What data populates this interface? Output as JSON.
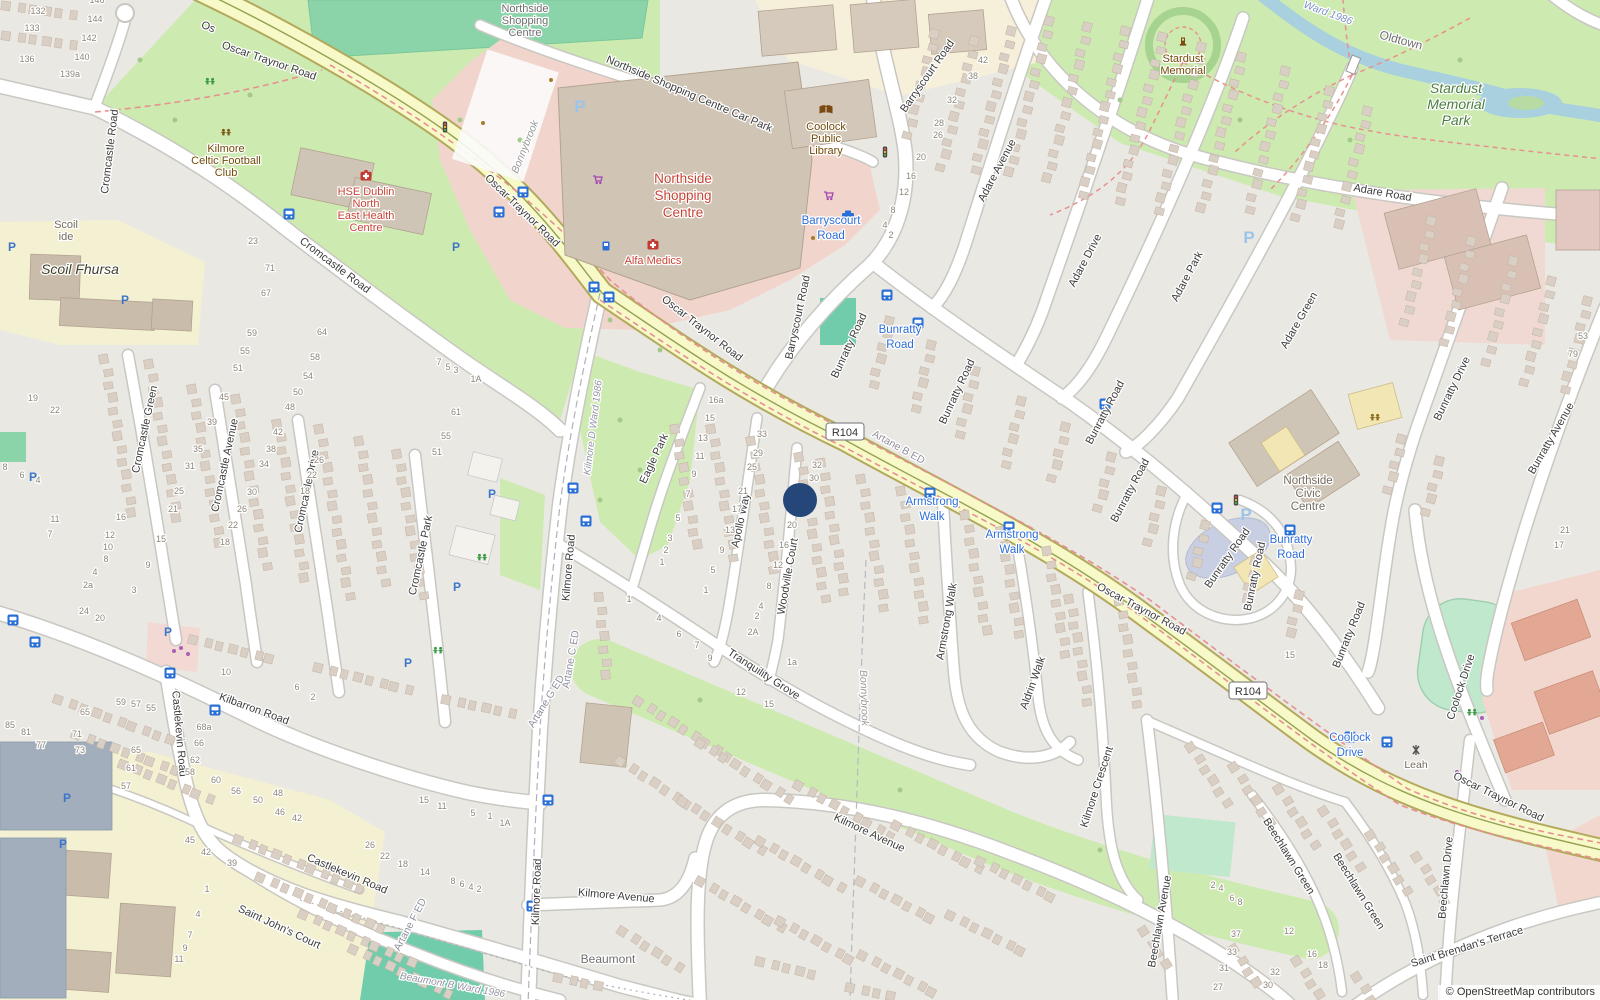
{
  "attribution": "© OpenStreetMap contributors",
  "marker": {
    "x": 800,
    "y": 500
  },
  "shields": [
    {
      "t": "R104",
      "x": 845,
      "y": 432
    },
    {
      "t": "R104",
      "x": 1248,
      "y": 691
    }
  ],
  "street_labels": [
    {
      "t": "Os",
      "x": 207,
      "y": 30,
      "r": 22
    },
    {
      "t": "Oscar Traynor Road",
      "x": 268,
      "y": 64,
      "r": 19
    },
    {
      "t": "Oscar Traynor Road",
      "x": 520,
      "y": 213,
      "r": 44
    },
    {
      "t": "Oscar Traynor Road",
      "x": 700,
      "y": 331,
      "r": 38
    },
    {
      "t": "Oscar Traynor Road",
      "x": 1140,
      "y": 612,
      "r": 28
    },
    {
      "t": "Oscar Traynor Road",
      "x": 1497,
      "y": 800,
      "r": 26
    },
    {
      "t": "Northside Shopping Centre Car Park",
      "x": 688,
      "y": 97,
      "r": 23
    },
    {
      "t": "Cromcastle Road",
      "x": 113,
      "y": 152,
      "r": -83
    },
    {
      "t": "Cromcastle Road",
      "x": 333,
      "y": 268,
      "r": 37
    },
    {
      "t": "Cromcastle Green",
      "x": 148,
      "y": 430,
      "r": -78
    },
    {
      "t": "Cromcastle Avenue",
      "x": 228,
      "y": 466,
      "r": -78
    },
    {
      "t": "Cromcastle Drive",
      "x": 310,
      "y": 492,
      "r": -78
    },
    {
      "t": "Cromcastle Park",
      "x": 424,
      "y": 556,
      "r": -78
    },
    {
      "t": "Kilbarron Road",
      "x": 253,
      "y": 712,
      "r": 20
    },
    {
      "t": "Castlekevin Road",
      "x": 176,
      "y": 734,
      "r": 85
    },
    {
      "t": "Castlekevin Road",
      "x": 346,
      "y": 877,
      "r": 23
    },
    {
      "t": "Saint John's Court",
      "x": 278,
      "y": 930,
      "r": 25
    },
    {
      "t": "Kilmore Road",
      "x": 572,
      "y": 568,
      "r": -85
    },
    {
      "t": "Kilmore Road",
      "x": 540,
      "y": 892,
      "r": -88
    },
    {
      "t": "Kilmore Avenue",
      "x": 616,
      "y": 899,
      "r": 5
    },
    {
      "t": "Kilmore Avenue",
      "x": 868,
      "y": 836,
      "r": 25
    },
    {
      "t": "Eagle Park",
      "x": 657,
      "y": 460,
      "r": -65
    },
    {
      "t": "Apollo Way",
      "x": 744,
      "y": 521,
      "r": -78
    },
    {
      "t": "Woodville Court",
      "x": 791,
      "y": 577,
      "r": -80
    },
    {
      "t": "Tranquility Grove",
      "x": 762,
      "y": 677,
      "r": 33
    },
    {
      "t": "Armstrong Walk",
      "x": 950,
      "y": 622,
      "r": -80
    },
    {
      "t": "Aldrin Walk",
      "x": 1036,
      "y": 684,
      "r": -70
    },
    {
      "t": "Kilmore Crescent",
      "x": 1100,
      "y": 788,
      "r": -72
    },
    {
      "t": "Beechlawn Avenue",
      "x": 1163,
      "y": 922,
      "r": -80
    },
    {
      "t": "Beechlawn Green",
      "x": 1286,
      "y": 858,
      "r": 58
    },
    {
      "t": "Beechlawn Green",
      "x": 1356,
      "y": 893,
      "r": 58
    },
    {
      "t": "Beechlawn Drive",
      "x": 1449,
      "y": 878,
      "r": -85
    },
    {
      "t": "Saint Brendan's Terrace",
      "x": 1468,
      "y": 950,
      "r": -17
    },
    {
      "t": "Barryscourt Road",
      "x": 930,
      "y": 78,
      "r": -55
    },
    {
      "t": "Barryscourt Road",
      "x": 801,
      "y": 318,
      "r": -78
    },
    {
      "t": "Bunratty Road",
      "x": 852,
      "y": 347,
      "r": -65
    },
    {
      "t": "Bunratty Road",
      "x": 960,
      "y": 393,
      "r": -65
    },
    {
      "t": "Bunratty Road",
      "x": 1108,
      "y": 414,
      "r": -62
    },
    {
      "t": "Bunratty Road",
      "x": 1133,
      "y": 492,
      "r": -62
    },
    {
      "t": "Bunratty Road",
      "x": 1230,
      "y": 560,
      "r": -55
    },
    {
      "t": "Bunratty Road",
      "x": 1258,
      "y": 577,
      "r": -78
    },
    {
      "t": "Bunratty Road",
      "x": 1352,
      "y": 636,
      "r": -68
    },
    {
      "t": "Bunratty Drive",
      "x": 1455,
      "y": 390,
      "r": -64
    },
    {
      "t": "Bunratty Avenue",
      "x": 1554,
      "y": 440,
      "r": -60
    },
    {
      "t": "Adare Avenue",
      "x": 1000,
      "y": 172,
      "r": -62
    },
    {
      "t": "Adare Drive",
      "x": 1088,
      "y": 262,
      "r": -62
    },
    {
      "t": "Adare Park",
      "x": 1190,
      "y": 278,
      "r": -62
    },
    {
      "t": "Adare Green",
      "x": 1302,
      "y": 322,
      "r": -60
    },
    {
      "t": "Adare Road",
      "x": 1382,
      "y": 196,
      "r": 10
    },
    {
      "t": "Coolock Drive",
      "x": 1464,
      "y": 688,
      "r": -72
    }
  ],
  "transit_labels": [
    {
      "l1": "Barryscourt",
      "l2": "Road",
      "x": 831,
      "y": 224
    },
    {
      "l1": "Bunratty",
      "l2": "Road",
      "x": 900,
      "y": 333
    },
    {
      "l1": "Armstrong",
      "l2": "Walk",
      "x": 932,
      "y": 505
    },
    {
      "l1": "Armstrong",
      "l2": "Walk",
      "x": 1012,
      "y": 538
    },
    {
      "l1": "Bunratty",
      "l2": "Road",
      "x": 1291,
      "y": 543
    },
    {
      "l1": "Coolock",
      "l2": "Drive",
      "x": 1350,
      "y": 741
    }
  ],
  "poi_labels": [
    {
      "lines": [
        "Northside",
        "Shopping",
        "Centre"
      ],
      "x": 525,
      "y": 12,
      "cls": "grey",
      "lh": 12,
      "fs": 11
    },
    {
      "lines": [
        "Coolock",
        "Public",
        "Library"
      ],
      "x": 826,
      "y": 130,
      "cls": "brown",
      "icon": "library",
      "ix": 826,
      "iy": 110,
      "lh": 12,
      "fs": 11
    },
    {
      "lines": [
        "Northside",
        "Shopping",
        "Centre"
      ],
      "x": 683,
      "y": 183,
      "cls": "redbig",
      "lh": 17,
      "fs": 13.5
    },
    {
      "lines": [
        "Alfa Medics"
      ],
      "x": 653,
      "y": 264,
      "cls": "red",
      "icon": "hospital",
      "ix": 653,
      "iy": 245,
      "lh": 12,
      "fs": 11
    },
    {
      "lines": [
        "Kilmore",
        "Celtic Football",
        "Club"
      ],
      "x": 226,
      "y": 152,
      "cls": "brown",
      "icon": "pitch",
      "ix": 226,
      "iy": 133,
      "lh": 12,
      "fs": 11
    },
    {
      "lines": [
        "HSE Dublin",
        "North",
        "East Health",
        "Centre"
      ],
      "x": 366,
      "y": 195,
      "cls": "red",
      "icon": "hospital",
      "ix": 366,
      "iy": 176,
      "lh": 12,
      "fs": 11
    },
    {
      "lines": [
        "Scoil",
        "ide"
      ],
      "x": 66,
      "y": 228,
      "cls": "grey2",
      "lh": 12,
      "fs": 11
    },
    {
      "lines": [
        "Scoil Fhursa"
      ],
      "x": 80,
      "y": 274,
      "cls": "school",
      "lh": 14,
      "fs": 14
    },
    {
      "lines": [
        "Stardust",
        "Memorial"
      ],
      "x": 1183,
      "y": 62,
      "cls": "brown",
      "icon": "memorial",
      "ix": 1183,
      "iy": 42,
      "lh": 12,
      "fs": 11
    },
    {
      "lines": [
        "Stardust",
        "Memorial",
        "Park"
      ],
      "x": 1456,
      "y": 93,
      "cls": "green",
      "lh": 16,
      "fs": 14
    },
    {
      "lines": [
        "Northside",
        "Civic",
        "Centre"
      ],
      "x": 1308,
      "y": 484,
      "cls": "grey2",
      "lh": 13,
      "fs": 11.5
    },
    {
      "lines": [
        "Beaumont"
      ],
      "x": 608,
      "y": 963,
      "cls": "locality",
      "lh": 12,
      "fs": 12
    },
    {
      "lines": [
        "Leah"
      ],
      "x": 1416,
      "y": 768,
      "cls": "grey2",
      "icon": "crossing",
      "ix": 1416,
      "iy": 750,
      "lh": 12,
      "fs": 10.5
    }
  ],
  "boundary_labels": [
    {
      "t": "Oldtown",
      "x": 1400,
      "y": 44,
      "r": 15,
      "cls": "locality"
    },
    {
      "t": "Ward 1986",
      "x": 1327,
      "y": 16,
      "r": 20,
      "cls": "wardblue"
    },
    {
      "t": "Kilmore D Ward 1986",
      "x": 596,
      "y": 428,
      "r": -83,
      "cls": "ward"
    },
    {
      "t": "Artane C ED",
      "x": 574,
      "y": 660,
      "r": -80,
      "cls": "ed"
    },
    {
      "t": "Artane G ED",
      "x": 549,
      "y": 703,
      "r": -58,
      "cls": "ed"
    },
    {
      "t": "Artane F ED",
      "x": 413,
      "y": 926,
      "r": -62,
      "cls": "ed"
    },
    {
      "t": "Artane B ED",
      "x": 897,
      "y": 450,
      "r": 29,
      "cls": "ed"
    },
    {
      "t": "Beaumont B Ward 1986",
      "x": 452,
      "y": 988,
      "r": 10,
      "cls": "ward"
    },
    {
      "t": "Bonnybrook",
      "x": 528,
      "y": 148,
      "r": -68,
      "cls": "localityi"
    },
    {
      "t": "Bonnybrook",
      "x": 861,
      "y": 698,
      "r": 88,
      "cls": "localityi"
    }
  ],
  "house_numbers": [
    [
      "146",
      97,
      3
    ],
    [
      "144",
      95,
      22
    ],
    [
      "132",
      38,
      14
    ],
    [
      "133",
      32,
      31
    ],
    [
      "142",
      89,
      41
    ],
    [
      "136",
      27,
      62
    ],
    [
      "140",
      82,
      60
    ],
    [
      "139a",
      70,
      77
    ],
    [
      "23",
      253,
      244
    ],
    [
      "71",
      270,
      271
    ],
    [
      "67",
      266,
      296
    ],
    [
      "19",
      33,
      401
    ],
    [
      "22",
      55,
      413
    ],
    [
      "8",
      5,
      470
    ],
    [
      "6",
      22,
      478
    ],
    [
      "4",
      38,
      483
    ],
    [
      "11",
      55,
      522
    ],
    [
      "7",
      50,
      537
    ],
    [
      "16",
      121,
      520
    ],
    [
      "12",
      110,
      538
    ],
    [
      "10",
      108,
      550
    ],
    [
      "8",
      106,
      562
    ],
    [
      "4",
      95,
      575
    ],
    [
      "2a",
      88,
      588
    ],
    [
      "24",
      84,
      614
    ],
    [
      "20",
      100,
      621
    ],
    [
      "15",
      161,
      542
    ],
    [
      "9",
      148,
      568
    ],
    [
      "3",
      134,
      593
    ],
    [
      "59",
      252,
      336
    ],
    [
      "55",
      245,
      354
    ],
    [
      "51",
      238,
      371
    ],
    [
      "45",
      224,
      400
    ],
    [
      "39",
      212,
      425
    ],
    [
      "35",
      198,
      452
    ],
    [
      "31",
      190,
      469
    ],
    [
      "25",
      179,
      494
    ],
    [
      "21",
      173,
      512
    ],
    [
      "64",
      322,
      335
    ],
    [
      "58",
      315,
      360
    ],
    [
      "54",
      308,
      379
    ],
    [
      "50",
      298,
      395
    ],
    [
      "48",
      290,
      410
    ],
    [
      "42",
      278,
      435
    ],
    [
      "38",
      271,
      452
    ],
    [
      "34",
      264,
      467
    ],
    [
      "30",
      252,
      495
    ],
    [
      "26",
      242,
      512
    ],
    [
      "22",
      233,
      528
    ],
    [
      "18",
      225,
      545
    ],
    [
      "7",
      439,
      365
    ],
    [
      "5",
      448,
      370
    ],
    [
      "3",
      456,
      373
    ],
    [
      "1A",
      476,
      382
    ],
    [
      "61",
      456,
      415
    ],
    [
      "55",
      446,
      439
    ],
    [
      "51",
      437,
      455
    ],
    [
      "26",
      319,
      463
    ],
    [
      "22",
      312,
      478
    ],
    [
      "18",
      305,
      494
    ],
    [
      "10",
      226,
      675
    ],
    [
      "6",
      297,
      690
    ],
    [
      "2",
      313,
      700
    ],
    [
      "59",
      121,
      705
    ],
    [
      "57",
      136,
      707
    ],
    [
      "55",
      151,
      711
    ],
    [
      "65",
      85,
      715
    ],
    [
      "71",
      77,
      737
    ],
    [
      "73",
      80,
      753
    ],
    [
      "85",
      10,
      728
    ],
    [
      "81",
      26,
      735
    ],
    [
      "77",
      41,
      748
    ],
    [
      "65",
      136,
      753
    ],
    [
      "61",
      131,
      771
    ],
    [
      "57",
      126,
      789
    ],
    [
      "68a",
      204,
      730
    ],
    [
      "66",
      199,
      746
    ],
    [
      "62",
      195,
      763
    ],
    [
      "58",
      190,
      775
    ],
    [
      "60",
      216,
      783
    ],
    [
      "56",
      236,
      794
    ],
    [
      "50",
      258,
      803
    ],
    [
      "48",
      278,
      796
    ],
    [
      "46",
      280,
      815
    ],
    [
      "42",
      297,
      821
    ],
    [
      "45",
      190,
      843
    ],
    [
      "42",
      206,
      855
    ],
    [
      "39",
      232,
      866
    ],
    [
      "26",
      370,
      848
    ],
    [
      "22",
      385,
      859
    ],
    [
      "18",
      403,
      867
    ],
    [
      "15",
      424,
      803
    ],
    [
      "11",
      442,
      809
    ],
    [
      "5",
      473,
      816
    ],
    [
      "1",
      490,
      819
    ],
    [
      "1A",
      505,
      826
    ],
    [
      "14",
      425,
      875
    ],
    [
      "8",
      453,
      884
    ],
    [
      "6",
      462,
      887
    ],
    [
      "4",
      471,
      890
    ],
    [
      "2",
      479,
      892
    ],
    [
      "1",
      207,
      892
    ],
    [
      "4",
      198,
      917
    ],
    [
      "7",
      190,
      938
    ],
    [
      "9",
      185,
      951
    ],
    [
      "11",
      179,
      962
    ],
    [
      "16a",
      716,
      403
    ],
    [
      "15",
      710,
      421
    ],
    [
      "13",
      703,
      441
    ],
    [
      "11",
      700,
      459
    ],
    [
      "9",
      694,
      477
    ],
    [
      "7",
      688,
      497
    ],
    [
      "5",
      678,
      521
    ],
    [
      "3",
      670,
      541
    ],
    [
      "2",
      666,
      553
    ],
    [
      "1",
      662,
      565
    ],
    [
      "33",
      762,
      437
    ],
    [
      "29",
      758,
      456
    ],
    [
      "25",
      752,
      470
    ],
    [
      "21",
      743,
      494
    ],
    [
      "17",
      737,
      512
    ],
    [
      "13",
      730,
      533
    ],
    [
      "9",
      722,
      553
    ],
    [
      "5",
      713,
      573
    ],
    [
      "1",
      706,
      593
    ],
    [
      "32",
      817,
      468
    ],
    [
      "30",
      814,
      481
    ],
    [
      "20",
      792,
      528
    ],
    [
      "16",
      784,
      548
    ],
    [
      "12",
      778,
      568
    ],
    [
      "8",
      769,
      589
    ],
    [
      "4",
      761,
      609
    ],
    [
      "2",
      757,
      619
    ],
    [
      "2A",
      753,
      635
    ],
    [
      "1a",
      792,
      665
    ],
    [
      "1",
      629,
      602
    ],
    [
      "4",
      659,
      621
    ],
    [
      "6",
      679,
      637
    ],
    [
      "7",
      697,
      648
    ],
    [
      "9",
      710,
      661
    ],
    [
      "12",
      741,
      695
    ],
    [
      "15",
      769,
      707
    ],
    [
      "42",
      983,
      63
    ],
    [
      "38",
      973,
      79
    ],
    [
      "32",
      952,
      103
    ],
    [
      "28",
      939,
      126
    ],
    [
      "26",
      938,
      138
    ],
    [
      "20",
      921,
      160
    ],
    [
      "16",
      911,
      179
    ],
    [
      "12",
      904,
      195
    ],
    [
      "8",
      893,
      213
    ],
    [
      "4",
      885,
      228
    ],
    [
      "2",
      891,
      238
    ],
    [
      "53",
      1583,
      339
    ],
    [
      "79",
      1573,
      357
    ],
    [
      "21",
      1565,
      533
    ],
    [
      "17",
      1559,
      548
    ],
    [
      "15",
      1290,
      658
    ],
    [
      "2",
      1213,
      888
    ],
    [
      "4",
      1221,
      891
    ],
    [
      "6",
      1232,
      901
    ],
    [
      "8",
      1240,
      905
    ],
    [
      "37",
      1236,
      937
    ],
    [
      "33",
      1232,
      955
    ],
    [
      "31",
      1224,
      971
    ],
    [
      "27",
      1218,
      990
    ],
    [
      "12",
      1289,
      934
    ],
    [
      "16",
      1312,
      957
    ],
    [
      "18",
      1323,
      968
    ],
    [
      "32",
      1275,
      975
    ],
    [
      "30",
      1268,
      988
    ]
  ],
  "icons": {
    "bus": [
      [
        289,
        214
      ],
      [
        499,
        212
      ],
      [
        523,
        192
      ],
      [
        594,
        287
      ],
      [
        609,
        297
      ],
      [
        573,
        488
      ],
      [
        586,
        521
      ],
      [
        548,
        800
      ],
      [
        532,
        906
      ],
      [
        13,
        620
      ],
      [
        35,
        642
      ],
      [
        170,
        673
      ],
      [
        215,
        710
      ],
      [
        887,
        295
      ],
      [
        918,
        323
      ],
      [
        1105,
        404
      ],
      [
        930,
        493
      ],
      [
        1009,
        527
      ],
      [
        1217,
        508
      ],
      [
        1290,
        530
      ],
      [
        1350,
        737
      ],
      [
        1387,
        742
      ]
    ],
    "parking_small": [
      [
        456,
        247
      ],
      [
        125,
        300
      ],
      [
        12,
        247
      ],
      [
        33,
        477
      ],
      [
        492,
        494
      ],
      [
        457,
        587
      ],
      [
        168,
        632
      ],
      [
        408,
        663
      ],
      [
        67,
        798
      ],
      [
        63,
        844
      ]
    ],
    "parking_large": [
      [
        580,
        106
      ],
      [
        1249,
        237
      ],
      [
        1246,
        514
      ]
    ],
    "cart": [
      [
        598,
        180
      ],
      [
        829,
        196
      ]
    ],
    "taxi": [
      [
        848,
        215
      ]
    ],
    "fuel": [
      [
        606,
        246
      ]
    ],
    "playground_green": [
      [
        210,
        82
      ],
      [
        482,
        558
      ],
      [
        438,
        651
      ],
      [
        1472,
        713
      ]
    ],
    "playground_brown": [
      [
        1375,
        418
      ]
    ],
    "traffic_light": [
      [
        445,
        127
      ],
      [
        885,
        152
      ],
      [
        1236,
        500
      ]
    ],
    "shop_dot": [
      [
        174,
        651
      ],
      [
        181,
        648
      ],
      [
        188,
        654
      ],
      [
        1482,
        718
      ],
      [
        1457,
        772
      ]
    ],
    "poi_dot": [
      [
        551,
        80
      ],
      [
        483,
        123
      ],
      [
        813,
        238
      ]
    ]
  }
}
